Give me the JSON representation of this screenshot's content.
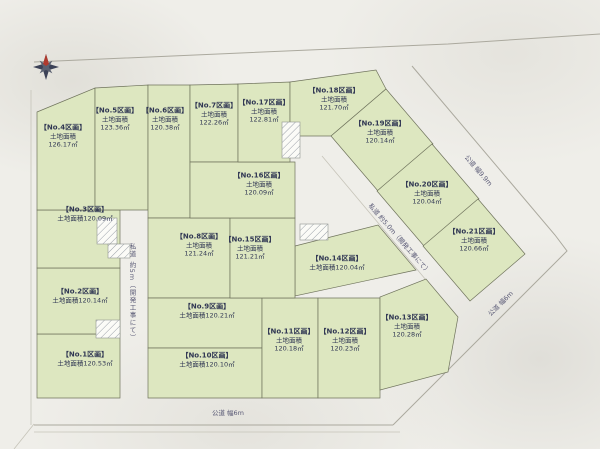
{
  "map": {
    "title": "分譲地区画図",
    "compass_icon": "north-compass-star",
    "colors": {
      "plot_fill": "#dde7c0",
      "plot_line": "#6f735c",
      "road_fill": "#f1f0ec",
      "outside": "#efeee9",
      "map_text": "#303753",
      "road_text": "#5a5a76"
    },
    "area_label": "土地面積",
    "plots": [
      {
        "id": "1",
        "label": "【No.1区画】",
        "area_label": "土地面積",
        "area": "120.53㎡"
      },
      {
        "id": "2",
        "label": "【No.2区画】",
        "area_label": "土地面積",
        "area": "120.14㎡"
      },
      {
        "id": "3",
        "label": "【No.3区画】",
        "area_label": "土地面積",
        "area": "120.09㎡"
      },
      {
        "id": "4",
        "label": "【No.4区画】",
        "area_label": "土地面積",
        "area": "126.17㎡"
      },
      {
        "id": "5",
        "label": "【No.5区画】",
        "area_label": "土地面積",
        "area": "123.36㎡"
      },
      {
        "id": "6",
        "label": "【No.6区画】",
        "area_label": "土地面積",
        "area": "120.38㎡"
      },
      {
        "id": "7",
        "label": "【No.7区画】",
        "area_label": "土地面積",
        "area": "122.26㎡"
      },
      {
        "id": "8",
        "label": "【No.8区画】",
        "area_label": "土地面積",
        "area": "121.24㎡"
      },
      {
        "id": "9",
        "label": "【No.9区画】",
        "area_label": "土地面積",
        "area": "120.21㎡"
      },
      {
        "id": "10",
        "label": "【No.10区画】",
        "area_label": "土地面積",
        "area": "120.10㎡"
      },
      {
        "id": "11",
        "label": "【No.11区画】",
        "area_label": "土地面積",
        "area": "120.18㎡"
      },
      {
        "id": "12",
        "label": "【No.12区画】",
        "area_label": "土地面積",
        "area": "120.23㎡"
      },
      {
        "id": "13",
        "label": "【No.13区画】",
        "area_label": "土地面積",
        "area": "120.28㎡"
      },
      {
        "id": "14",
        "label": "【No.14区画】",
        "area_label": "土地面積",
        "area": "120.04㎡"
      },
      {
        "id": "15",
        "label": "【No.15区画】",
        "area_label": "土地面積",
        "area": "121.21㎡"
      },
      {
        "id": "16",
        "label": "【No.16区画】",
        "area_label": "土地面積",
        "area": "120.09㎡"
      },
      {
        "id": "17",
        "label": "【No.17区画】",
        "area_label": "土地面積",
        "area": "122.81㎡"
      },
      {
        "id": "18",
        "label": "【No.18区画】",
        "area_label": "土地面積",
        "area": "121.70㎡"
      },
      {
        "id": "19",
        "label": "【No.19区画】",
        "area_label": "土地面積",
        "area": "120.14㎡"
      },
      {
        "id": "20",
        "label": "【No.20区画】",
        "area_label": "土地面積",
        "area": "120.04㎡"
      },
      {
        "id": "21",
        "label": "【No.21区画】",
        "area_label": "土地面積",
        "area": "120.66㎡"
      }
    ],
    "roads": [
      {
        "id": "private-road-vertical",
        "label": "私道 約5m（開発工事にて）"
      },
      {
        "id": "private-road-diagonal",
        "label": "私道 約5.0m（開発工事にて）"
      },
      {
        "id": "public-road-top",
        "label": "公道 幅9.9m"
      },
      {
        "id": "public-road-bottom",
        "label": "公道 幅6m"
      },
      {
        "id": "public-road-southeast",
        "label": "公道 幅6m"
      }
    ]
  }
}
